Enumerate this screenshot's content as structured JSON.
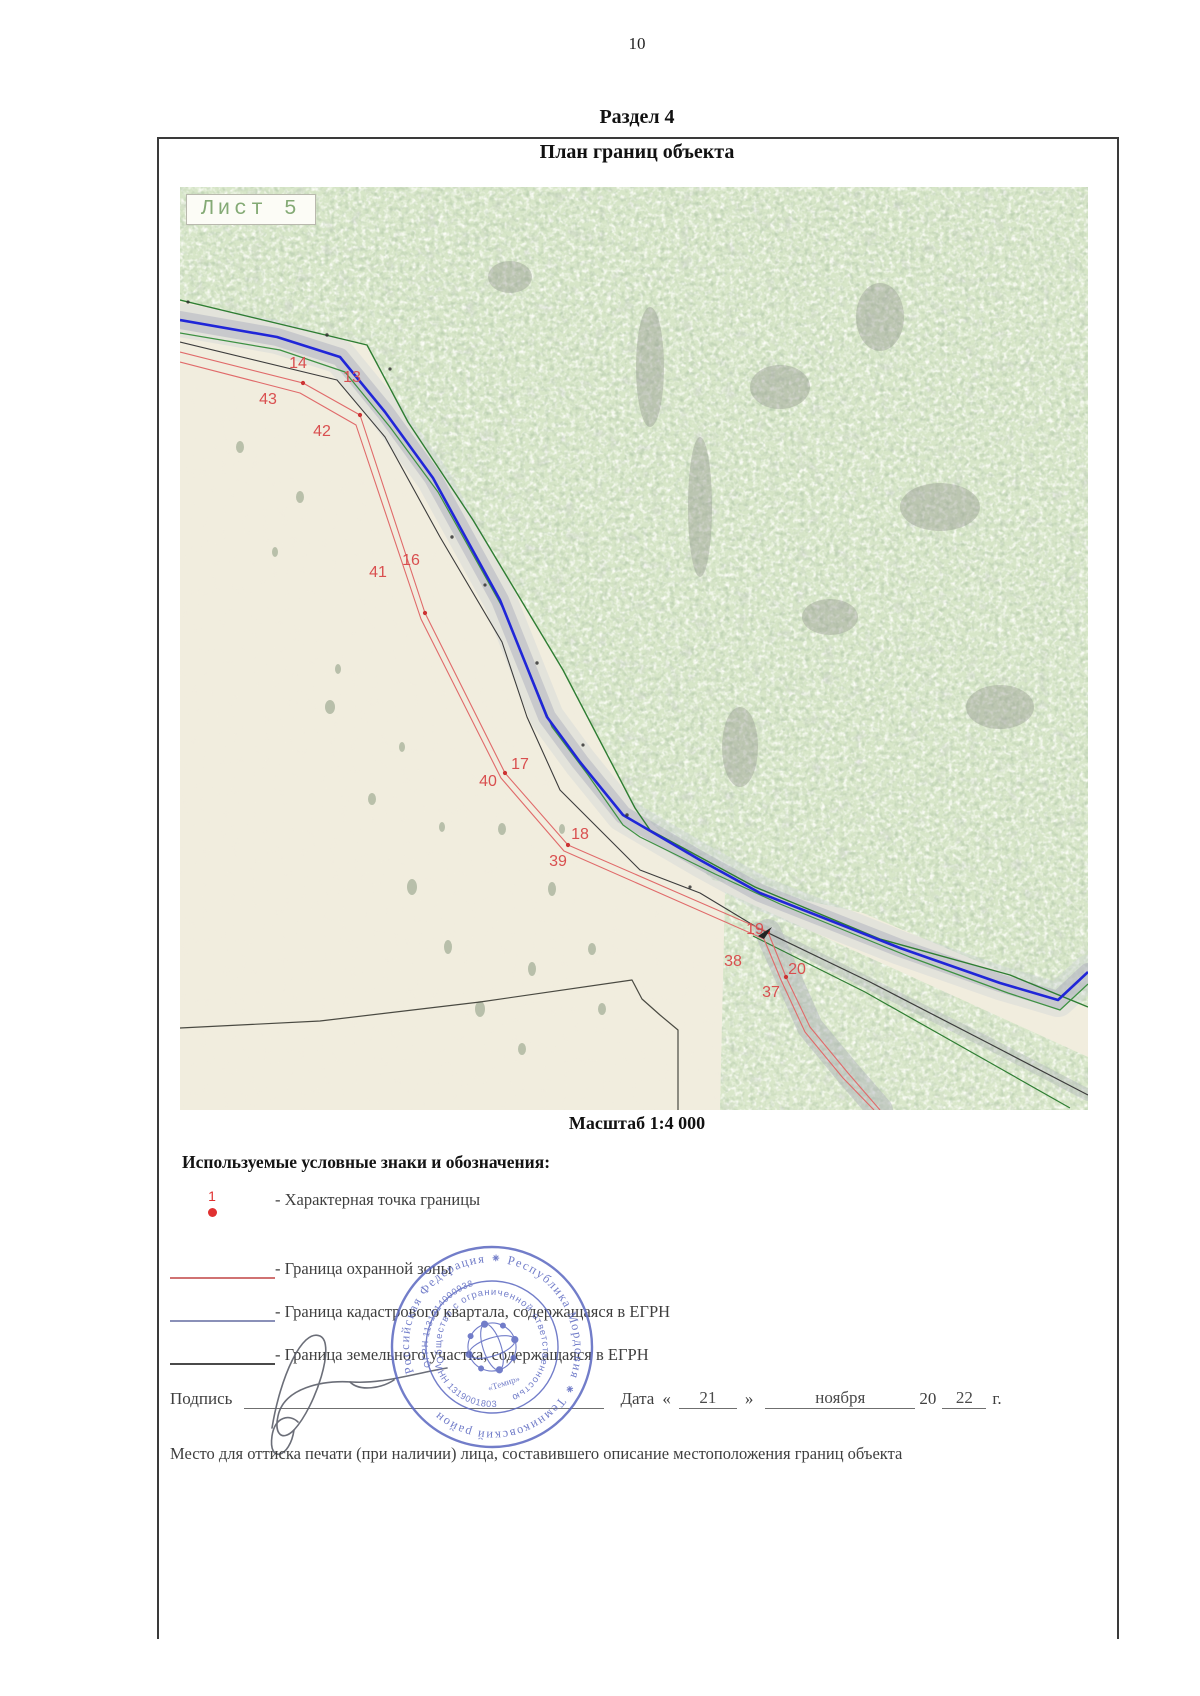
{
  "header": {
    "page_number": "10",
    "section_title": "Раздел 4",
    "document_title": "План границ объекта"
  },
  "map": {
    "sheet_label": "Лист 5",
    "scale_label": "Масштаб 1:4 000",
    "boundary_points": [
      {
        "label": "14",
        "x": 118,
        "y": 177
      },
      {
        "label": "43",
        "x": 88,
        "y": 213
      },
      {
        "label": "13",
        "x": 172,
        "y": 191
      },
      {
        "label": "42",
        "x": 142,
        "y": 245
      },
      {
        "label": "41",
        "x": 198,
        "y": 386
      },
      {
        "label": "16",
        "x": 231,
        "y": 374
      },
      {
        "label": "17",
        "x": 340,
        "y": 578
      },
      {
        "label": "40",
        "x": 308,
        "y": 595
      },
      {
        "label": "18",
        "x": 400,
        "y": 648
      },
      {
        "label": "39",
        "x": 378,
        "y": 675
      },
      {
        "label": "19",
        "x": 575,
        "y": 743
      },
      {
        "label": "38",
        "x": 553,
        "y": 775
      },
      {
        "label": "20",
        "x": 617,
        "y": 783
      },
      {
        "label": "37",
        "x": 591,
        "y": 806
      }
    ],
    "line_colors": {
      "protection_zone": "#e06a6a",
      "cadastral_egrn": "#2026d8",
      "land_parcel": "#3c3c3c",
      "outer_green": "#2e7d32"
    }
  },
  "legend": {
    "header": "Используемые условные знаки и обозначения:",
    "items": [
      {
        "type": "point",
        "symbol_label": "1",
        "color": "#e03131",
        "label": "- Характерная точка границы"
      },
      {
        "type": "line",
        "color": "#d07272",
        "label": "- Граница охранной зоны"
      },
      {
        "type": "line",
        "color": "#8a90b8",
        "label": "- Граница кадастрового квартала, содержащаяся в ЕГРН"
      },
      {
        "type": "line",
        "color": "#4a4a4a",
        "label": "- Граница земельного участка, содержащаяся в ЕГРН"
      }
    ]
  },
  "signature": {
    "label": "Подпись",
    "date_label": "Дата",
    "quote_open": "«",
    "day": "21",
    "quote_close": "»",
    "month": "ноября",
    "year_prefix": "20",
    "year": "22",
    "year_suffix": "г."
  },
  "stamp": {
    "outer_ring": "Российская Федерация ⁕ Республика Мордовия ⁕ Темниковский район",
    "inner_ring": "Общество с ограниченной ответственностью",
    "ogrn": "ОГРН 1131314000938",
    "inn": "ИНН 1319001803",
    "center_name": "«Темир»",
    "color": "#5a67c0"
  },
  "stamp_note": "Место для оттиска печати (при наличии) лица, составившего описание местоположения границ объекта"
}
